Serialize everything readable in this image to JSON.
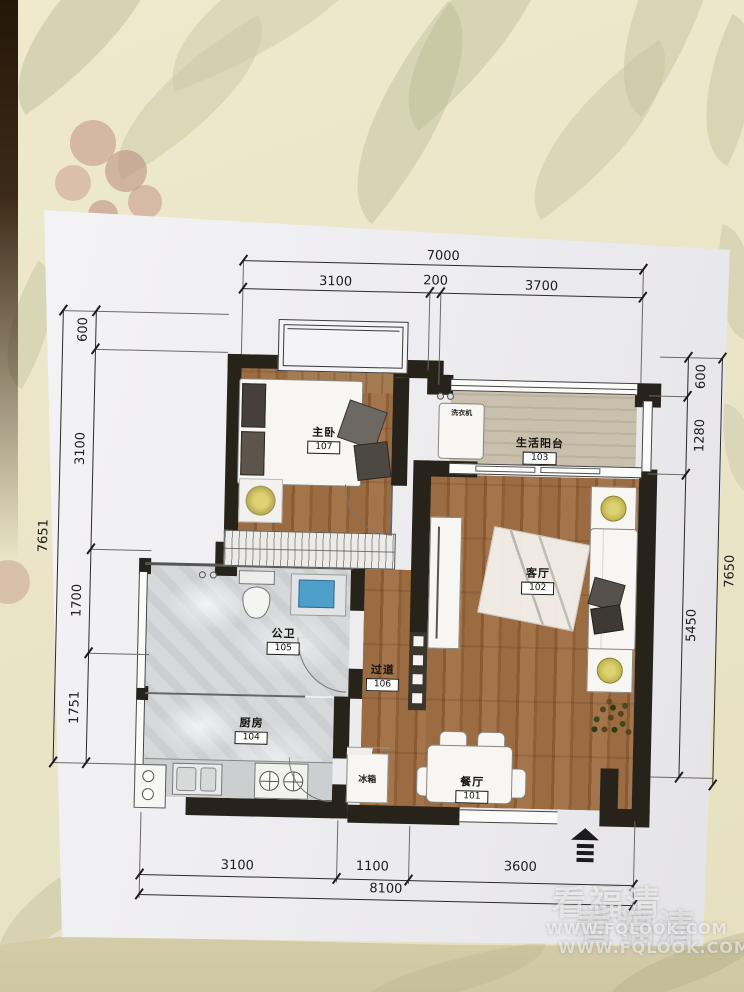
{
  "floorplan": {
    "rooms": {
      "bedroom": {
        "name": "主卧",
        "number": "107"
      },
      "balcony": {
        "name": "生活阳台",
        "number": "103"
      },
      "living": {
        "name": "客厅",
        "number": "102"
      },
      "bathroom": {
        "name": "公卫",
        "number": "105"
      },
      "corridor": {
        "name": "过道",
        "number": "106"
      },
      "kitchen": {
        "name": "厨房",
        "number": "104"
      },
      "dining": {
        "name": "餐厅",
        "number": "101"
      }
    },
    "appliances": {
      "fridge": "冰箱",
      "washer": "洗衣机"
    },
    "dims": {
      "top": {
        "overall": "7000",
        "seg1": "3100",
        "seg2": "200",
        "seg3": "3700"
      },
      "left": {
        "overall": "7651",
        "seg1": "600",
        "seg2": "3100",
        "seg3": "1700",
        "seg4": "1751"
      },
      "right": {
        "overall": "7650",
        "seg1": "600",
        "seg2": "1280",
        "seg3": "5450"
      },
      "bottom": {
        "overall": "8100",
        "seg1": "3100",
        "seg2": "1100",
        "seg3": "3600"
      }
    },
    "colors": {
      "wall": "#27231b",
      "woodFloor": "#9b6b41",
      "balconyFloor": "#c8bfac",
      "marble": "#d6d8da",
      "sinkBlue": "#4e9fc9",
      "lampYellow": "#d6ca63",
      "paper": "#f1f0f3"
    }
  },
  "watermark": {
    "brand": "看福清",
    "site": "WWW.FQLOOK.COM"
  }
}
